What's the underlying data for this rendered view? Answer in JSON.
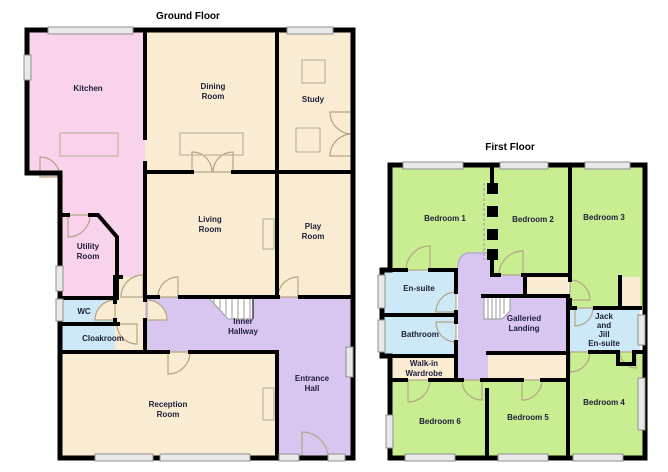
{
  "palette": {
    "wall": "#000000",
    "pink": "#f8d3eb",
    "cream": "#faecd2",
    "green": "#c9ee92",
    "blue": "#cde8f7",
    "purple": "#d9c6f0",
    "window": "#e9e9e9",
    "text": "#1c1c38",
    "door_line": "#b4a584",
    "furniture_line": "#c0b49c",
    "stair_line": "#9a9a9a"
  },
  "ground_floor": {
    "title": "Ground Floor",
    "rooms": {
      "kitchen": {
        "lines": [
          "Kitchen"
        ]
      },
      "dining_room": {
        "lines": [
          "Dining",
          "Room"
        ]
      },
      "study": {
        "lines": [
          "Study"
        ]
      },
      "living_room": {
        "lines": [
          "Living",
          "Room"
        ]
      },
      "play_room": {
        "lines": [
          "Play",
          "Room"
        ]
      },
      "utility_room": {
        "lines": [
          "Utility",
          "Room"
        ]
      },
      "wc": {
        "lines": [
          "WC"
        ]
      },
      "cloakroom": {
        "lines": [
          "Cloakroom"
        ]
      },
      "inner_hallway": {
        "lines": [
          "Inner",
          "Hallway"
        ]
      },
      "reception_room": {
        "lines": [
          "Reception",
          "Room"
        ]
      },
      "entrance_hall": {
        "lines": [
          "Entrance",
          "Hall"
        ]
      }
    }
  },
  "first_floor": {
    "title": "First Floor",
    "rooms": {
      "bedroom_1": {
        "lines": [
          "Bedroom 1"
        ]
      },
      "bedroom_2": {
        "lines": [
          "Bedroom 2"
        ]
      },
      "bedroom_3": {
        "lines": [
          "Bedroom 3"
        ]
      },
      "en_suite": {
        "lines": [
          "En-suite"
        ]
      },
      "bathroom": {
        "lines": [
          "Bathroom"
        ]
      },
      "galleried_landing": {
        "lines": [
          "Galleried",
          "Landing"
        ]
      },
      "jack_and_jill_en_suite": {
        "lines": [
          "Jack",
          "and",
          "Jill",
          "En-suite"
        ]
      },
      "walk_in_wardrobe": {
        "lines": [
          "Walk-in",
          "Wardrobe"
        ]
      },
      "bedroom_6": {
        "lines": [
          "Bedroom 6"
        ]
      },
      "bedroom_5": {
        "lines": [
          "Bedroom 5"
        ]
      },
      "bedroom_4": {
        "lines": [
          "Bedroom 4"
        ]
      }
    }
  }
}
